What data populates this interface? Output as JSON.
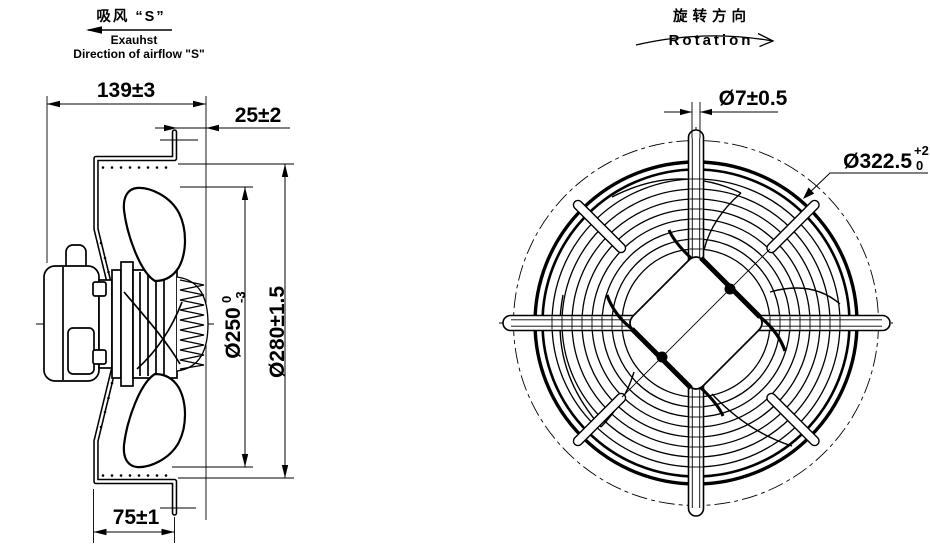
{
  "annotations": {
    "airflow": {
      "zh": "吸风 “S”",
      "en1": "Exauhst",
      "en2": "Direction of airflow \"S\""
    },
    "rotation": {
      "zh": "旋转方向",
      "en": "Rotation"
    }
  },
  "side_view": {
    "dim_depth": "139±3",
    "dim_guard_gap": "25±2",
    "dim_plate_width": "75±1",
    "dim_impeller": {
      "base": "Ø250",
      "tol_upper": "0",
      "tol_lower": "-3"
    },
    "dim_opening": "Ø280±1.5"
  },
  "front_view": {
    "dim_wire": "Ø7±0.5",
    "dim_guard": {
      "base": "Ø322.5",
      "tol_upper": "+2",
      "tol_lower": "0"
    }
  },
  "colors": {
    "line": "#000000",
    "background": "#ffffff"
  }
}
